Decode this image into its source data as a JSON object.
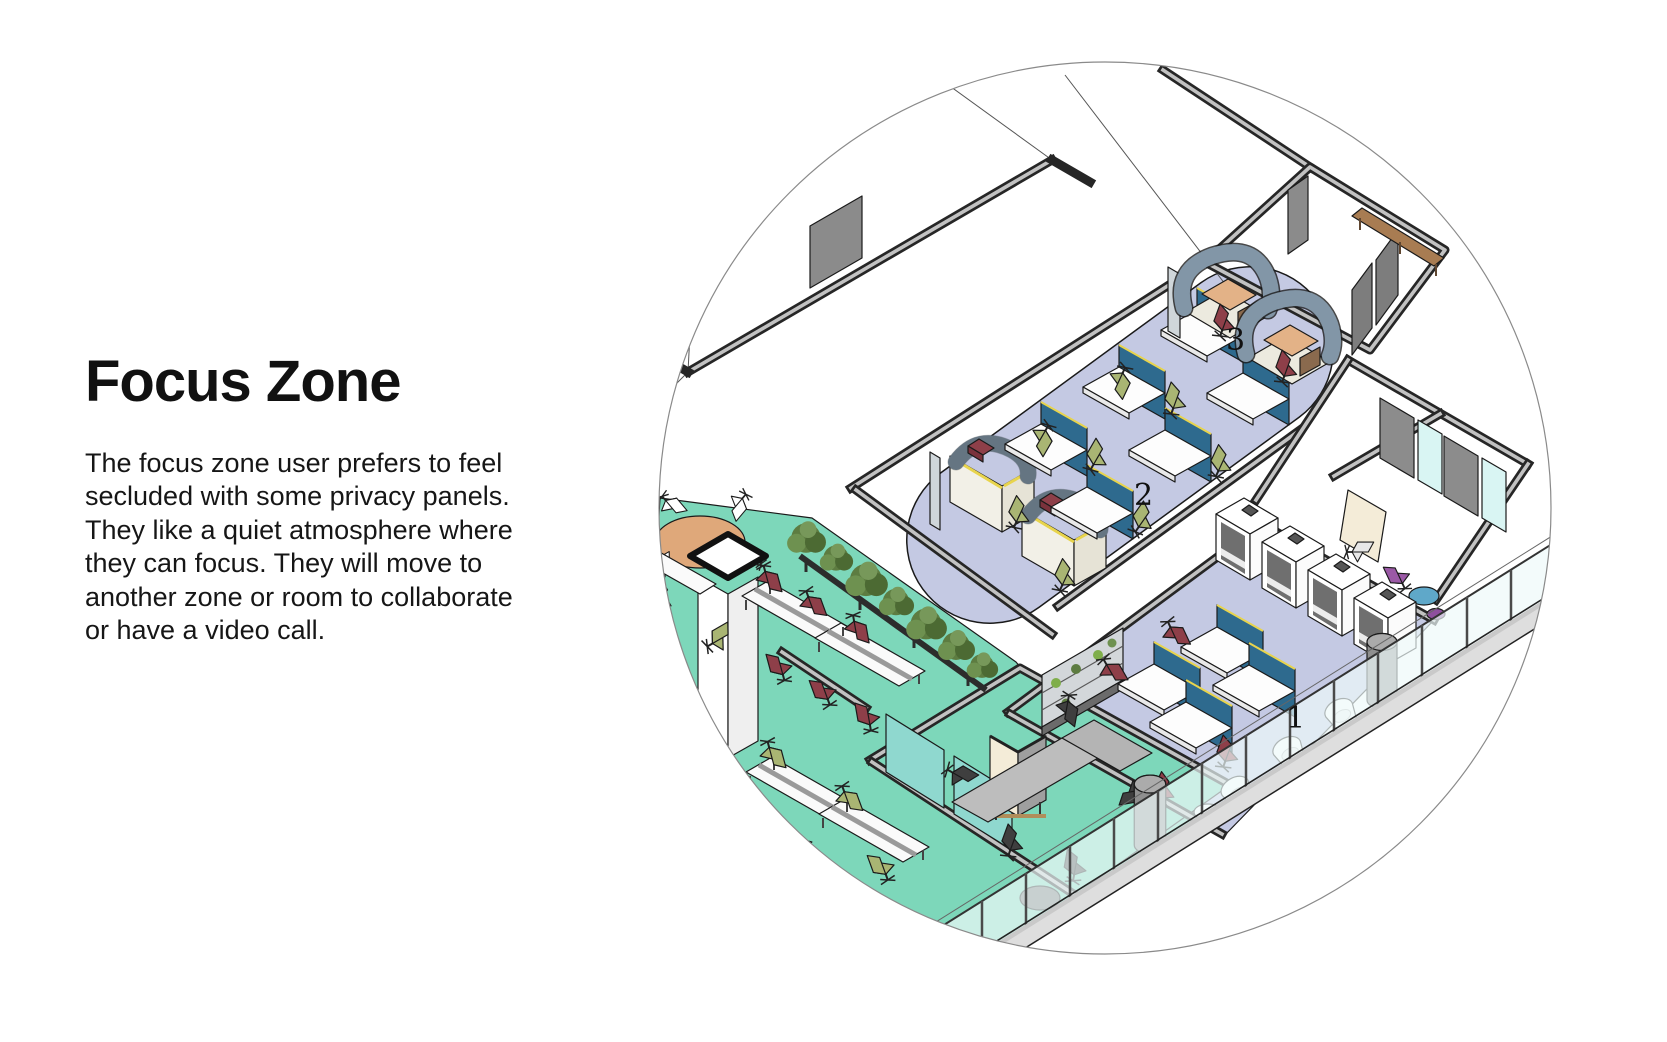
{
  "heading": {
    "title": "Focus Zone"
  },
  "intro": {
    "lines": [
      "The focus zone user prefers to feel",
      "secluded with some privacy panels.",
      "They like a quiet atmosphere where",
      "they can focus. They will move to",
      "another zone or room to collaborate",
      "or have a video call."
    ]
  },
  "illustration": {
    "kind": "isometric office floor plan cropped in a circle",
    "zone_labels": [
      "1",
      "2",
      "3"
    ],
    "colors": {
      "floor_lavender": "#c4c9e3",
      "floor_teal": "#7dd7ba",
      "panel_blue": "#2e6a8e",
      "chair_olive": "#a9b573",
      "chair_maroon": "#8e3f49",
      "booth_slate": "#7e93a4",
      "desk_tan": "#e3b287",
      "bench_brown": "#a87c52",
      "glass_teal": "#8fd8cf",
      "glass_cyan": "#d9f5f3",
      "whiteboard_cream": "#f4ecd8",
      "trim_yellow": "#e8d44d"
    }
  }
}
